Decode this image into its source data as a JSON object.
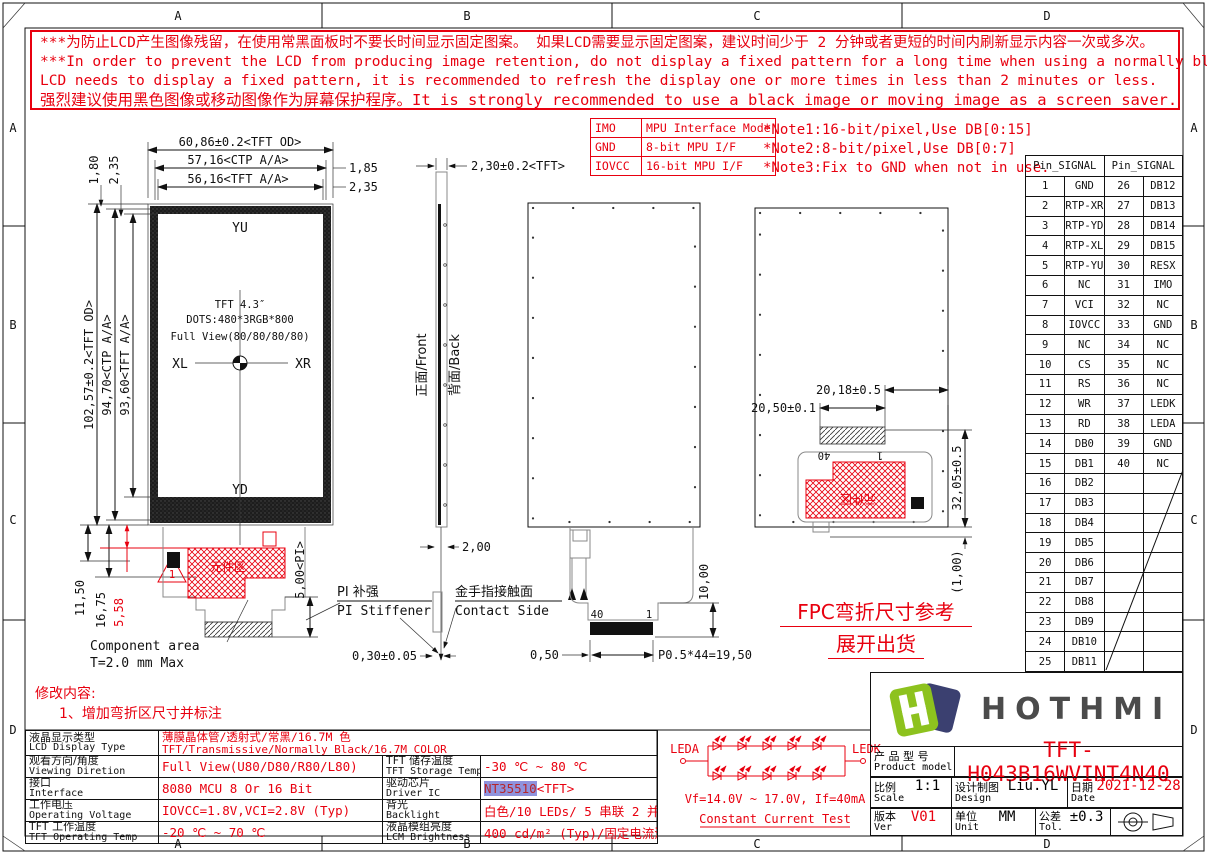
{
  "frame": {
    "cols": [
      "A",
      "B",
      "C",
      "D"
    ],
    "rows": [
      "A",
      "B",
      "C",
      "D"
    ]
  },
  "warning": {
    "line1": "***为防止LCD产生图像残留，在使用常黑面板时不要长时间显示固定图案。 如果LCD需要显示固定图案，建议时间少于 2 分钟或者更短的时间内刷新显示内容一次或多次。",
    "line2": "***In order to prevent the LCD from producing image retention, do not display a fixed pattern for a long time when using a normally black panel. If the",
    "line3": " LCD needs to display a fixed pattern, it is recommended to refresh the display one or more times in less than 2 minutes or less.",
    "line4": "强烈建议使用黑色图像或移动图像作为屏幕保护程序。It is strongly recommended to use a black image or moving image as a screen saver."
  },
  "iface": {
    "rows": [
      [
        "IMO",
        "MPU Interface Mode"
      ],
      [
        "GND",
        "8-bit MPU I/F"
      ],
      [
        "IOVCC",
        "16-bit MPU I/F"
      ]
    ]
  },
  "notes": [
    "*Note1:16-bit/pixel,Use DB[0:15]",
    "*Note2:8-bit/pixel,Use DB[0:7]",
    "*Note3:Fix to GND  when not in use."
  ],
  "pins": {
    "header": "Pin_SIGNAL",
    "left": [
      [
        "1",
        "GND"
      ],
      [
        "2",
        "RTP-XR"
      ],
      [
        "3",
        "RTP-YD"
      ],
      [
        "4",
        "RTP-XL"
      ],
      [
        "5",
        "RTP-YU"
      ],
      [
        "6",
        "NC"
      ],
      [
        "7",
        "VCI"
      ],
      [
        "8",
        "IOVCC"
      ],
      [
        "9",
        "NC"
      ],
      [
        "10",
        "CS"
      ],
      [
        "11",
        "RS"
      ],
      [
        "12",
        "WR"
      ],
      [
        "13",
        "RD"
      ],
      [
        "14",
        "DB0"
      ],
      [
        "15",
        "DB1"
      ],
      [
        "16",
        "DB2"
      ],
      [
        "17",
        "DB3"
      ],
      [
        "18",
        "DB4"
      ],
      [
        "19",
        "DB5"
      ],
      [
        "20",
        "DB6"
      ],
      [
        "21",
        "DB7"
      ],
      [
        "22",
        "DB8"
      ],
      [
        "23",
        "DB9"
      ],
      [
        "24",
        "DB10"
      ],
      [
        "25",
        "DB11"
      ]
    ],
    "right": [
      [
        "26",
        "DB12"
      ],
      [
        "27",
        "DB13"
      ],
      [
        "28",
        "DB14"
      ],
      [
        "29",
        "DB15"
      ],
      [
        "30",
        "RESX"
      ],
      [
        "31",
        "IMO"
      ],
      [
        "32",
        "NC"
      ],
      [
        "33",
        "GND"
      ],
      [
        "34",
        "NC"
      ],
      [
        "35",
        "NC"
      ],
      [
        "36",
        "NC"
      ],
      [
        "37",
        "LEDK"
      ],
      [
        "38",
        "LEDA"
      ],
      [
        "39",
        "GND"
      ],
      [
        "40",
        "NC"
      ],
      [
        "",
        ""
      ],
      [
        "",
        ""
      ],
      [
        "",
        ""
      ],
      [
        "",
        ""
      ],
      [
        "",
        ""
      ],
      [
        "",
        ""
      ],
      [
        "",
        ""
      ],
      [
        "",
        ""
      ],
      [
        "",
        ""
      ],
      [
        "",
        ""
      ]
    ]
  },
  "drawing": {
    "dim_tft_od_w": "60,86±0.2<TFT OD>",
    "dim_ctp_w": "57,16<CTP A/A>",
    "dim_tft_aa_w": "56,16<TFT A/A>",
    "dim_185": "1,85",
    "dim_235r": "2,35",
    "dim_180": "1,80",
    "dim_235l": "2,35",
    "dim_tft_od_h": "102,57±0.2<TFT OD>",
    "dim_ctp_h": "94,70<CTP A/A>",
    "dim_tft_aa_h": "93,60<TFT A/A>",
    "dim_1150": "11,50",
    "dim_1675": "16,75",
    "dim_558": "5,58",
    "flag1": "1",
    "yu": "YU",
    "yd": "YD",
    "xl": "XL",
    "xr": "XR",
    "tft_size": "TFT 4.3″",
    "dots": "DOTS:480*3RGB*800",
    "full_view": "Full View(80/80/80/80)",
    "comp_cn": "元件区",
    "comp_en1": "Component area",
    "comp_en2": "T=2.0 mm Max",
    "pi_dim": "5,00<PI>",
    "pi_cn": "PI 补强",
    "pi_en": "PI Stiffener",
    "contact_cn": "金手指接触面",
    "contact_en": "Contact Side",
    "dim_030": "0,30±0.05",
    "dim_200": "2,00",
    "front_label": "正面/Front",
    "back_label": "背面/Back",
    "side_dim": "2,30±0.2<TFT>",
    "pin40": "40",
    "pin1": "1",
    "dim_050": "0,50",
    "pitch": "P0.5*44=19,50",
    "dim_1000": "10,00",
    "pin40b": "40",
    "pin1b": "1",
    "dim_2018": "20,18±0.5",
    "dim_2050": "20,50±0.1",
    "dim_3205": "32,05±0.5",
    "dim_100": "(1,00)",
    "comp_cn_b": "元件区"
  },
  "fold_note1": "FPC弯折尺寸参考",
  "fold_note2": "展开出货",
  "revision": {
    "title": "修改内容:",
    "item": "1、增加弯折区尺寸并标注"
  },
  "spec": {
    "rows": [
      {
        "l1": "液晶显示类型",
        "l2": "LCD Display Type",
        "v1": "薄膜晶体管/透射式/常黑/16.7M 色",
        "v2": "TFT/Transmissive/Normally Black/16.7M COLOR"
      },
      {
        "l1": "观看方向/角度",
        "l2": "Viewing Diretion",
        "v": "Full View(U80/D80/R80/L80)",
        "r1": "TFT 储存温度",
        "r2": "TFT Storage Temp",
        "rv": "-30 ℃ ~ 80 ℃"
      },
      {
        "l1": "接口",
        "l2": "Interface",
        "v": "8080 MCU 8 Or 16 Bit",
        "r1": "驱动芯片",
        "r2": "Driver IC",
        "rv_hl": "NT35510",
        "rv_rest": "<TFT>"
      },
      {
        "l1": "工作电压",
        "l2": "Operating Voltage",
        "v": "IOVCC=1.8V,VCI=2.8V (Typ)",
        "r1": "背光",
        "r2": "Backlight",
        "rv": "白色/10 LEDs/ 5 串联 2 并联"
      },
      {
        "l1": "TFT 工作温度",
        "l2": "TFT Operating Temp",
        "v": "-20 ℃ ~ 70 ℃",
        "r1": "液晶模组亮度",
        "r2": "LCM Brightness",
        "rv": "400 cd/m² (Typ)/固定电流测试"
      }
    ]
  },
  "led": {
    "leda": "LEDA",
    "ledk": "LEDK",
    "vf": "Vf=14.0V ~ 17.0V, If=40mA",
    "test": "Constant Current Test"
  },
  "tb": {
    "logo_text": "HOTHMI",
    "product_cn": "产 品 型 号",
    "product_en": "Product model",
    "product_value": "TFT-H043B16WVINT4N40",
    "scale_cn": "比例",
    "scale_en": "Scale",
    "scale_value": "1:1",
    "design_cn": "设计制图",
    "design_en": "Design",
    "design_value": "Liu.YL",
    "date_cn": "日期",
    "date_en": "Date",
    "date_value": "2021-12-28",
    "ver_cn": "版本",
    "ver_en": "Ver",
    "ver_value": "V01",
    "unit_cn": "单位",
    "unit_en": "Unit",
    "unit_value": "MM",
    "tol_cn": "公差",
    "tol_en": "Tol.",
    "tol_value": "±0.3"
  }
}
